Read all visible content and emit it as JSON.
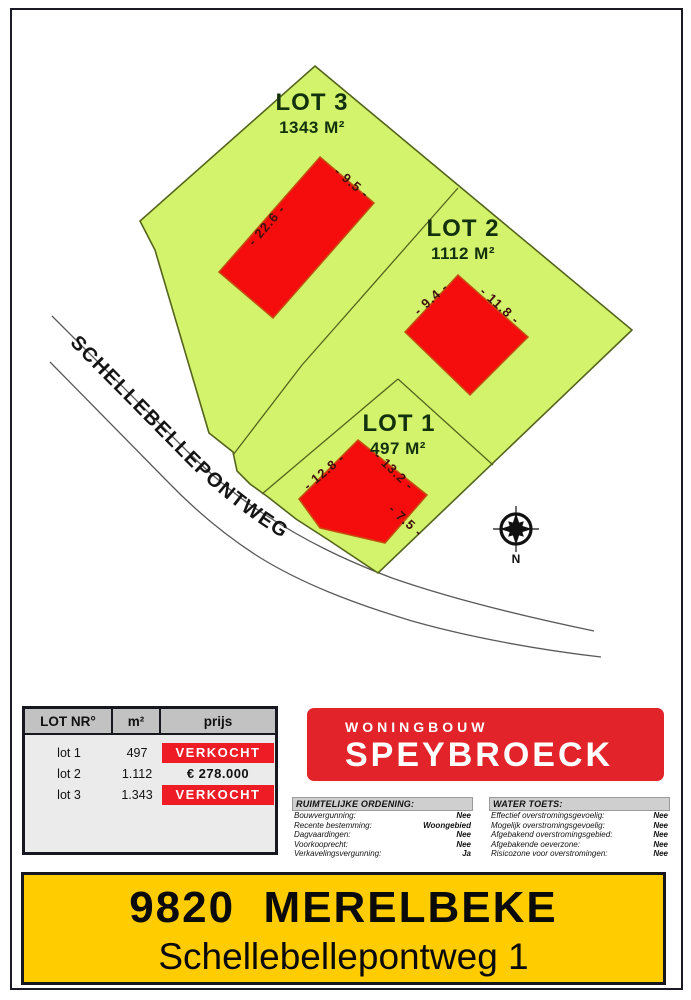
{
  "map": {
    "road_label": "SCHELLEBELLEPONTWEG",
    "compass_label": "N",
    "lots": [
      {
        "name": "LOT 3",
        "area": "1343 M²",
        "dims": [
          "- 22.6 -",
          "- 9.5 -"
        ]
      },
      {
        "name": "LOT 2",
        "area": "1112 M²",
        "dims": [
          "- 9.4 -",
          "- 11.8 -"
        ]
      },
      {
        "name": "LOT 1",
        "area": "497 M²",
        "dims": [
          "- 12.8 -",
          "- 13.2 -",
          "- 7.5 -"
        ]
      }
    ]
  },
  "price_table": {
    "headers": [
      "LOT NR°",
      "m²",
      "prijs"
    ],
    "rows": [
      {
        "lot": "lot 1",
        "m2": "497",
        "price": "VERKOCHT",
        "sold": true
      },
      {
        "lot": "lot 2",
        "m2": "1.112",
        "price": "€ 278.000",
        "sold": false
      },
      {
        "lot": "lot 3",
        "m2": "1.343",
        "price": "VERKOCHT",
        "sold": true
      }
    ]
  },
  "logo": {
    "line1": "WONINGBOUW",
    "line2": "SPEYBROECK"
  },
  "panels": [
    {
      "title": "RUIMTELIJKE ORDENING:",
      "rows": [
        {
          "label": "Bouwvergunning:",
          "value": "Nee"
        },
        {
          "label": "Recente bestemming:",
          "value": "Woongebied"
        },
        {
          "label": "Dagvaardingen:",
          "value": "Nee"
        },
        {
          "label": "Voorkooprecht:",
          "value": "Nee"
        },
        {
          "label": "Verkavelingsvergunning:",
          "value": "Ja"
        }
      ]
    },
    {
      "title": "WATER TOETS:",
      "rows": [
        {
          "label": "Effectief overstromingsgevoelig:",
          "value": "Nee"
        },
        {
          "label": "Mogelijk overstromingsgevoelig:",
          "value": "Nee"
        },
        {
          "label": "Afgebakend overstromingsgebied:",
          "value": "Nee"
        },
        {
          "label": "Afgebakende oeverzone:",
          "value": "Nee"
        },
        {
          "label": "Risicozone voor overstromingen:",
          "value": "Nee"
        }
      ]
    }
  ],
  "banner": {
    "line1": "9820  MERELBEKE",
    "line2": "Schellebellepontweg 1"
  },
  "colors": {
    "lot_green": "#d2f36b",
    "lot_border": "#55641c",
    "building_red": "#f50d0d",
    "logo_red": "#e2242a",
    "sold_red": "#ee1c25",
    "banner_yellow": "#ffcc00"
  }
}
